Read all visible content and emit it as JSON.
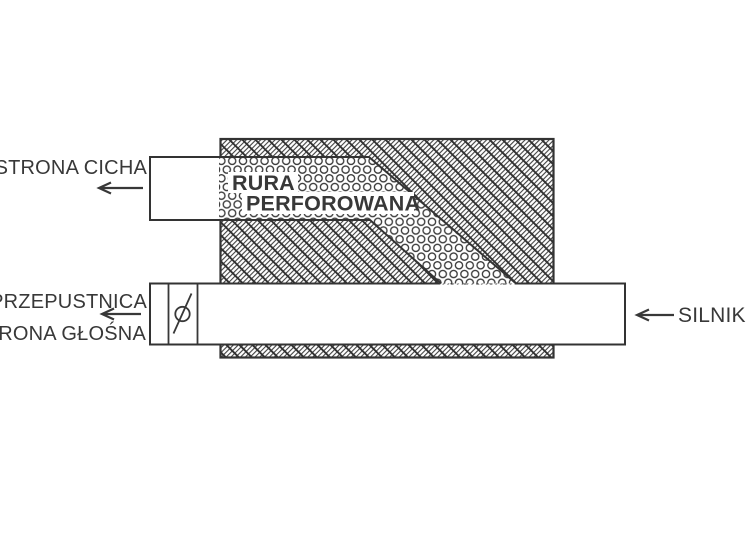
{
  "diagram": {
    "labels": {
      "quiet_side": "STRONA CICHA",
      "throttle": "PRZEPUSTNICA",
      "loud_side": "STRONA GŁOŚNA",
      "engine": "SILNIK",
      "perforated_pipe_line1": "RURA",
      "perforated_pipe_line2": "PERFOROWANA"
    },
    "icons": {
      "quiet_side_arrow": "left-arrow",
      "loud_side_arrow": "left-arrow",
      "engine_arrow": "left-arrow",
      "valve_symbol": "butterfly-valve"
    },
    "colors": {
      "ink": "#383838",
      "hatch": "#2f2f2f",
      "background": "#ffffff"
    }
  }
}
